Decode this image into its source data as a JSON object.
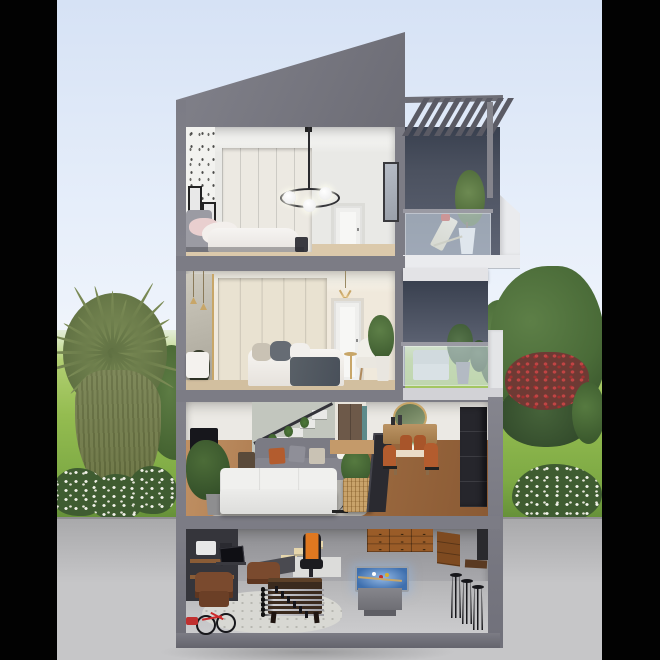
{
  "scene": {
    "description": "Photorealistic 3D cross-section rendering of a four-storey modern townhouse with an angular mono-pitch roof, pergola roof terrace and balcony, set on a lawn with trees, letterboxed by black side bars",
    "floors": [
      {
        "id": "attic-bedroom",
        "label": "top-floor bedroom",
        "items": [
          "bed with pink and white pillows",
          "speckled wallpaper",
          "picture frames",
          "white wardrobe",
          "ring pendant light with globes",
          "white interior door",
          "wall mirror"
        ]
      },
      {
        "id": "master-bedroom",
        "label": "second-floor bedroom",
        "items": [
          "bed with gray throw",
          "cream wardrobe",
          "gold sputnik chandelier",
          "mirror panel with pendant lights",
          "white armchair",
          "side table",
          "potted plant",
          "white interior door",
          "bench"
        ]
      },
      {
        "id": "living-floor",
        "label": "ground-floor living and dining room",
        "items": [
          "white sofa",
          "gray sofa with cushions",
          "tv and media console",
          "staircase with plants",
          "monstera houseplant",
          "arc floor lamp",
          "center plant with rattan basket",
          "leaning art frame",
          "brown front door with sidelight",
          "round gold mirror",
          "wood sideboard",
          "dining table with flowers",
          "rust dining chairs",
          "tall dark cabinet"
        ]
      },
      {
        "id": "basement",
        "label": "basement game room",
        "items": [
          "wood staircase",
          "desk with monitor",
          "orange gaming chair",
          "leather armchairs",
          "foosball table",
          "glowing pool table",
          "wood drawer cabinets",
          "bar ledge with stools",
          "bicycle",
          "red toy",
          "rug",
          "shelving on dark wall"
        ]
      }
    ],
    "exterior": [
      "angular gray roof",
      "pergola slats over roof terrace",
      "lounge deck chair with red cushion",
      "potted tree in white planter",
      "glass balcony railings",
      "outdoor sofa with plants",
      "white parapet fin",
      "cabbage tree",
      "round shrubs",
      "white flowering bushes",
      "red flowering shrub",
      "large green tree",
      "lawn",
      "concrete foreground wall",
      "black letterbox bars"
    ],
    "counts": {
      "pergola_slats": 9,
      "attic_wardrobe_panels": 5,
      "bedroom_wardrobe_panels": 5,
      "living_stair_steps": 6,
      "basement_stair_steps": 5,
      "foosball_rods": 6,
      "bar_stools": 3,
      "tree_leaves": 24,
      "chandelier_spokes": 6,
      "pendant_globes": 3
    },
    "colors": {
      "letterbox": "#020202",
      "skyTop": "#d6e2f5",
      "skyMid": "#e6eefa",
      "skyLow": "#f2f6fc",
      "lawnFar": "#c2da85",
      "lawn": "#94bc50",
      "lawnNear": "#7da944",
      "lawnShadow": "#648f38",
      "concrete": "#c6c6c8",
      "concreteTop": "#a9a9ab",
      "concreteEdge": "#8f8f91",
      "frame": "#7c7c85",
      "frameDark": "#5a5a64",
      "roofA": "#82828b",
      "roofB": "#6c6c75",
      "terraceWallA": "#39404f",
      "terraceWallB": "#5d6373",
      "whiteTrim": "#eaebee",
      "glass": "rgba(213,226,238,0.55)",
      "rail": "#9a9aa3",
      "ceiling": "#f5f5f3",
      "wall1": "#e9e9e6",
      "wallpaper": "#f2f2ef",
      "wardrobe1": "#ece9e2",
      "wall2": "#f0e9dc",
      "wardrobe2": "#e9e2d1",
      "doorWhite": "#f7f7f5",
      "doorBrown": "#6d5949",
      "sidelight": "#5d8b8b",
      "woodEdge1": "#dbc9ab",
      "woodEdge2": "#d2bf9f",
      "woodFloorA": "#9c6a40",
      "woodFloorB": "#c09063",
      "rug": "#b2b0ab",
      "rugBasement": "#d8d8d3",
      "sofaWhite": "#f0f0ee",
      "sofaGray": "#7b7b84",
      "pillowRust": "#b35c2e",
      "pillowGray": "#8f8f98",
      "pillowCream": "#c9c2b4",
      "pillowPink": "#e9cfcf",
      "throw": "#596067",
      "headboard": "#9b9ba3",
      "gold": "#c8a668",
      "tv": "#17171c",
      "cabinetDark": "#26262c",
      "basementWallA": "#8f8f93",
      "basementWallB": "#aaaaae",
      "basementFloor": "#c3c3c5",
      "darkWall": "#35353b",
      "woodCabinetA": "#9a5c28",
      "woodCabinetB": "#7e4a20",
      "barWood": "#5a3a22",
      "felt": "#3e6fae",
      "feltGlow": "#93b8e4",
      "poolBody": "#86868c",
      "leather": "#7a4a2e",
      "orange": "#e07820",
      "stepWood": "#e6d6ac",
      "stairWhite": "#e9e9e7",
      "olive": "#7d8d57",
      "oliveDark": "#5f7042",
      "skirtA": "#7a8454",
      "skirtB": "#67713f",
      "treeGreen": "#4a6b38",
      "treeDark": "#36512a",
      "bushGreen": "#3f5c31",
      "redBloom": "#b03636",
      "flowerWhite": "#f2f2ea"
    }
  }
}
